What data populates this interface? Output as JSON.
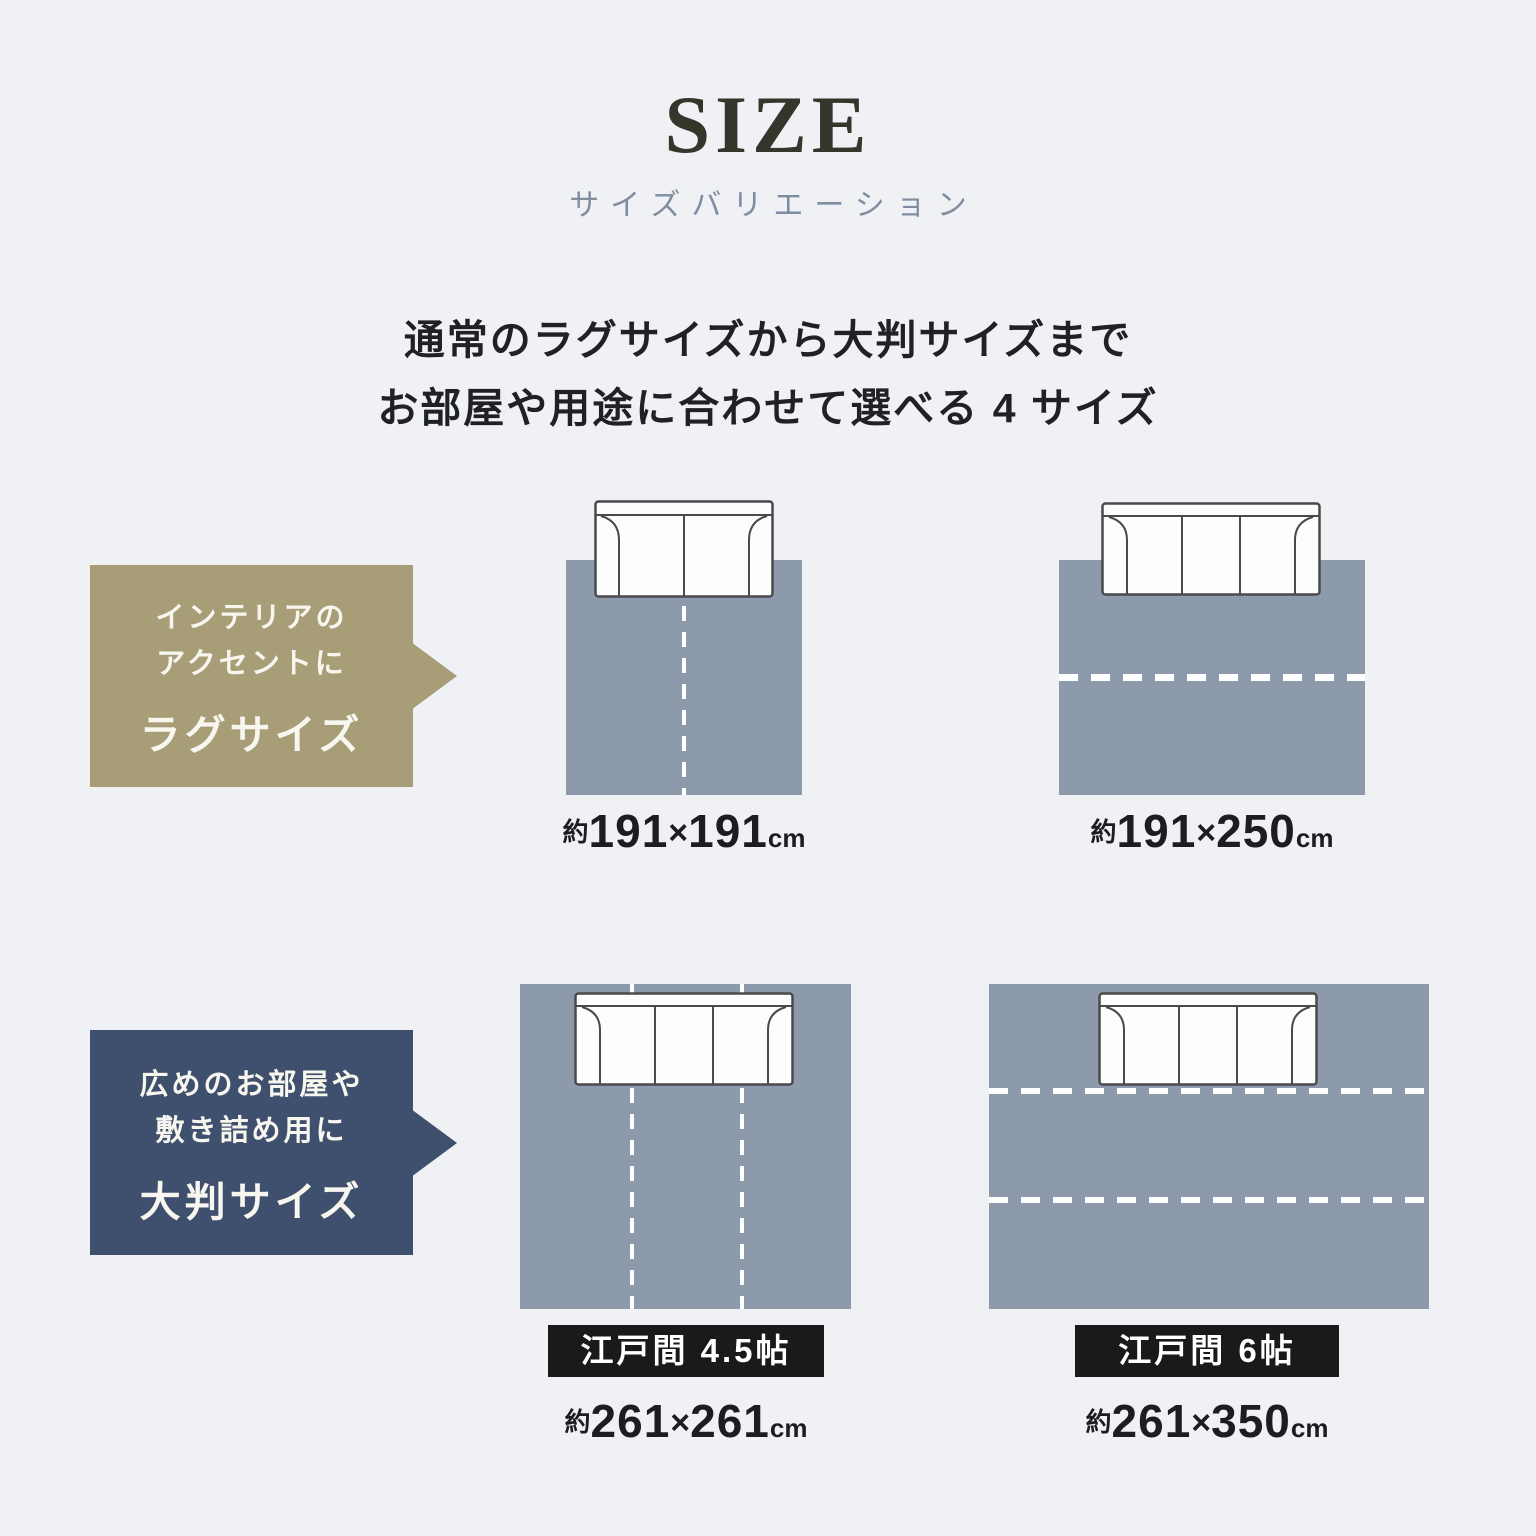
{
  "header": {
    "title": "SIZE",
    "subtitle": "サイズバリエーション"
  },
  "intro": {
    "line1": "通常のラグサイズから大判サイズまで",
    "line2": "お部屋や用途に合わせて選べる 4 サイズ"
  },
  "callouts": {
    "rug": {
      "line1": "インテリアの",
      "line2": "アクセントに",
      "title": "ラグサイズ",
      "color": "#a79d76"
    },
    "large": {
      "line1": "広めのお部屋や",
      "line2": "敷き詰め用に",
      "title": "大判サイズ",
      "color": "#3f506e"
    }
  },
  "rugs": [
    {
      "yaku": "約",
      "w": "191",
      "times": "×",
      "h": "191",
      "unit": "cm",
      "sofa_seats": 2,
      "divider": "vertical-center"
    },
    {
      "yaku": "約",
      "w": "191",
      "times": "×",
      "h": "250",
      "unit": "cm",
      "sofa_seats": 3,
      "divider": "horizontal-center"
    },
    {
      "yaku": "約",
      "w": "261",
      "times": "×",
      "h": "261",
      "unit": "cm",
      "sofa_seats": 3,
      "divider": "two-vertical",
      "badge": "江戸間 4.5帖"
    },
    {
      "yaku": "約",
      "w": "261",
      "times": "×",
      "h": "350",
      "unit": "cm",
      "sofa_seats": 3,
      "divider": "two-horizontal",
      "badge": "江戸間 6帖"
    }
  ],
  "icons": {
    "sofa_two_seat": "sofa-2seat-icon",
    "sofa_three_seat": "sofa-3seat-icon"
  },
  "colors": {
    "background": "#eff1f4",
    "rug_fill": "#8d9aab",
    "dash_line": "#ffffff",
    "callout_tan": "#a79d76",
    "callout_navy": "#3f506e",
    "badge_background": "#1a1a1a",
    "badge_text": "#ffffff",
    "title_text": "#35352c",
    "subtitle_text": "#7e8da0",
    "body_text": "#1f2124",
    "label_text": "#1d1d1f",
    "sofa_fill": "#fdfdfd",
    "sofa_outline": "#4a4a4c"
  }
}
